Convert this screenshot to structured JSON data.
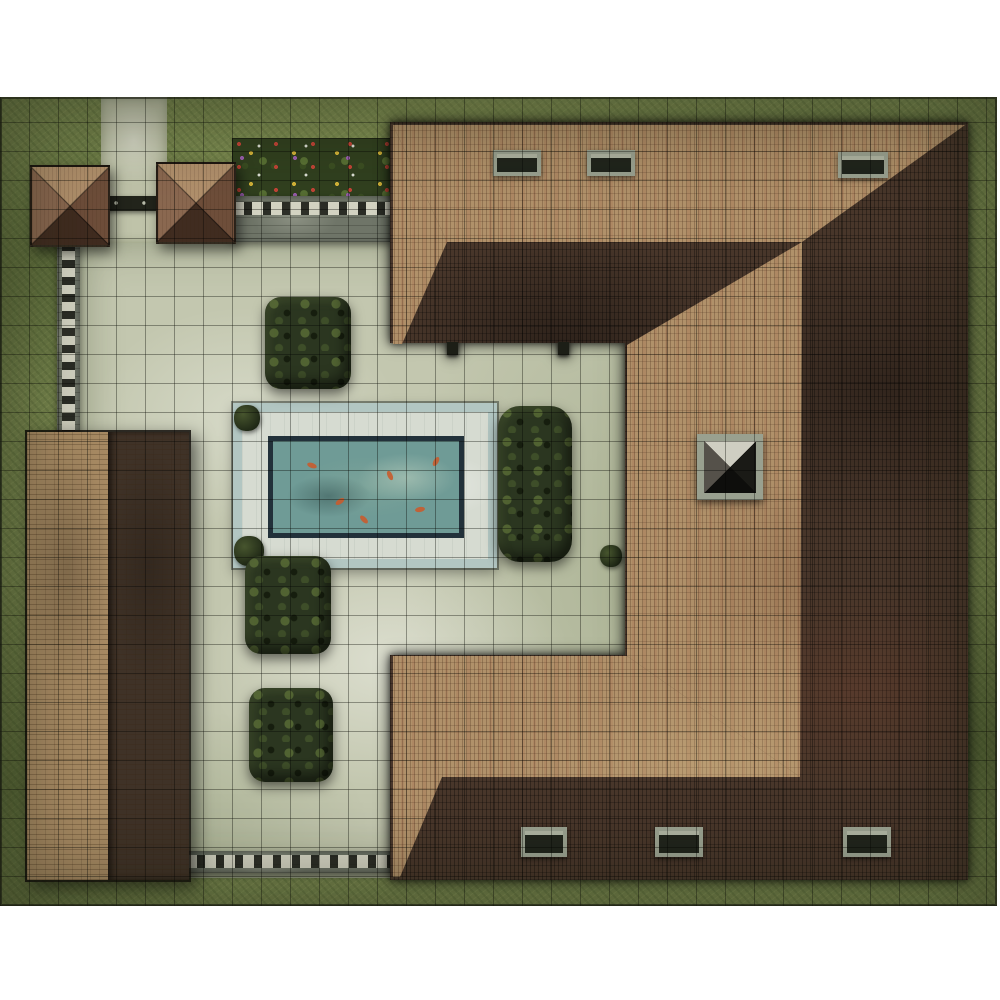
{
  "meta": {
    "title": "Top-down villa courtyard battle map",
    "description": "Printed square-grid tabletop battle mat: a U-shaped villa with hipped clay-tile roof wraps a paved courtyard containing a rectangular koi pool, clipped hedges, garden pavilions, stone walls, a flower bed and surrounding grass lawn.",
    "grid": {
      "cell_px": 29,
      "style": "square overlay",
      "line_color": "#14160e"
    }
  },
  "palette": {
    "page-bg": "#ffffff",
    "grass": "#76854d",
    "grass-dark": "#4f5f33",
    "courtyard": "#c3c7af",
    "courtyard-light": "#dfe1d2",
    "path": "#bfc3a9",
    "roof-tan": "#b0916a",
    "roof-dark": "#48362a",
    "roof-red": "#8e5a42",
    "barn-tan": "#a78a63",
    "barn-dark": "#3f3227",
    "wall-grey": "#6f7568",
    "wall-dash": "#d3d3c2",
    "hedge": "#2b3620",
    "hedge-light": "#49572e",
    "pool-rim": "#b2c6c2",
    "pool-marble": "#d6dbd1",
    "pool-edge": "#22313a",
    "water": "#6f9b96",
    "koi": "#c85c2e",
    "flowerbed": "#31401f",
    "pavilion-light": "#b1906c",
    "pavilion-dark": "#402c20",
    "stone-frame": "#99a08f",
    "outline": "#191812"
  },
  "features": {
    "map": {
      "label": "Villa courtyard battle map"
    },
    "grass": {
      "label": "Grass lawn"
    },
    "courtyard": {
      "label": "Paved courtyard"
    },
    "path": {
      "label": "Stone path"
    },
    "gate": {
      "label": "Garden gate between pavilions"
    },
    "pavilion": {
      "label": "Garden pavilion with pyramid roof"
    },
    "flowerbed": {
      "label": "Flower bed with mixed blooms"
    },
    "wall": {
      "label": "Stone garden wall"
    },
    "barn": {
      "label": "Long outbuilding with gabled tile roof"
    },
    "villa": {
      "label": "U-shaped villa with hipped tile roof"
    },
    "roof_light_slope": {
      "label": "Sunlit tile roof slope"
    },
    "roof_dark_slope": {
      "label": "Shaded tile roof slope"
    },
    "chimney": {
      "label": "Stone chimney"
    },
    "dormer": {
      "label": "Roof dormer window"
    },
    "pool": {
      "label": "Koi pool with marble rim"
    },
    "water": {
      "label": "Pool water"
    },
    "koi": {
      "label": "Koi fish"
    },
    "hedge": {
      "label": "Clipped hedge bush"
    },
    "tuft": {
      "label": "Small shrub"
    },
    "post": {
      "label": "Porch post"
    }
  },
  "counts": {
    "pavilions": 2,
    "hedges": 5,
    "koi": 6,
    "dormers": 6,
    "chimneys": 1,
    "shrubs": 3,
    "walls": 3
  }
}
